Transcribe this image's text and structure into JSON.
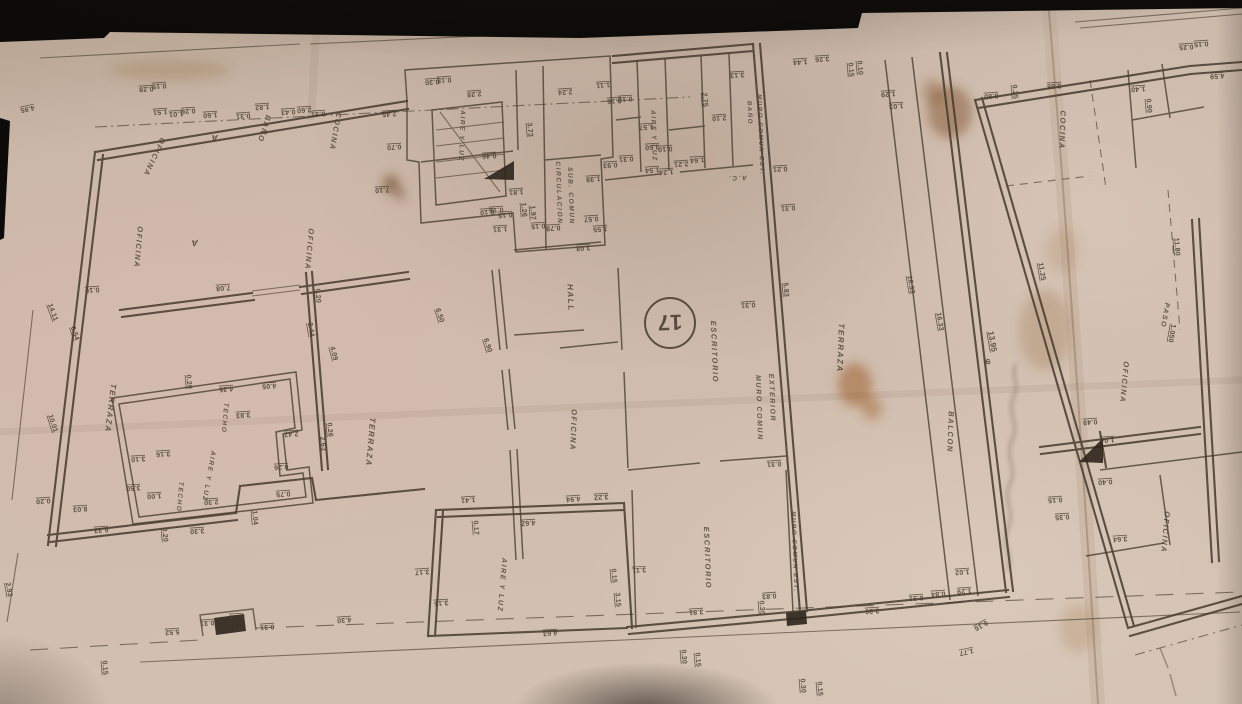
{
  "palette": {
    "paper": "#ccbaab",
    "ink": "#45392c",
    "stain": "#8a5320",
    "shadow": "#141210"
  },
  "plate": {
    "number": "17"
  },
  "handwriting": {
    "legible_part": "13.95"
  },
  "rooms": [
    {
      "t": "OFICINA",
      "x": 152,
      "y": 156,
      "r": 115,
      "s": 7.5
    },
    {
      "t": "A",
      "x": 214,
      "y": 135,
      "r": 178,
      "s": 9
    },
    {
      "t": "BAÑO",
      "x": 262,
      "y": 128,
      "r": 108,
      "s": 7.5
    },
    {
      "t": "COCINA",
      "x": 333,
      "y": 131,
      "r": 100,
      "s": 7.5
    },
    {
      "t": "OFICINA",
      "x": 136,
      "y": 247,
      "r": 95,
      "s": 7.5
    },
    {
      "t": "A",
      "x": 194,
      "y": 240,
      "r": 178,
      "s": 9
    },
    {
      "t": "OFICINA",
      "x": 307,
      "y": 249,
      "r": 95,
      "s": 7.5
    },
    {
      "t": "AIRE Y LUZ",
      "x": 460,
      "y": 136,
      "r": 92,
      "s": 6.5
    },
    {
      "t": "CIRCULACION",
      "x": 557,
      "y": 193,
      "r": 88,
      "s": 6.5
    },
    {
      "t": "SUB. COMUN",
      "x": 569,
      "y": 196,
      "r": 88,
      "s": 6.5
    },
    {
      "t": "AIRE Y LUZ",
      "x": 652,
      "y": 136,
      "r": 88,
      "s": 6.5
    },
    {
      "t": "BAÑO",
      "x": 748,
      "y": 113,
      "r": 88,
      "s": 6
    },
    {
      "t": "A.C.",
      "x": 737,
      "y": 176,
      "r": 178,
      "s": 6.5
    },
    {
      "t": "MURO COMUN EST.",
      "x": 759,
      "y": 135,
      "r": 88,
      "s": 6
    },
    {
      "t": "HALL",
      "x": 568,
      "y": 298,
      "r": 88,
      "s": 8
    },
    {
      "t": "ESCRITORIO",
      "x": 712,
      "y": 352,
      "r": 88,
      "s": 7.5
    },
    {
      "t": "MURO COMUN",
      "x": 757,
      "y": 408,
      "r": 88,
      "s": 7
    },
    {
      "t": "EXTERIOR",
      "x": 770,
      "y": 398,
      "r": 88,
      "s": 7
    },
    {
      "t": "TERRAZA",
      "x": 108,
      "y": 408,
      "r": 97,
      "s": 8
    },
    {
      "t": "TECHO",
      "x": 223,
      "y": 418,
      "r": 95,
      "s": 6.5
    },
    {
      "t": "AIRE Y LUZ",
      "x": 207,
      "y": 476,
      "r": 100,
      "s": 6.5
    },
    {
      "t": "TECHO",
      "x": 178,
      "y": 497,
      "r": 95,
      "s": 6.5
    },
    {
      "t": "TERRAZA",
      "x": 368,
      "y": 442,
      "r": 95,
      "s": 8
    },
    {
      "t": "TERRAZA",
      "x": 838,
      "y": 348,
      "r": 92,
      "s": 8
    },
    {
      "t": "BALCON",
      "x": 948,
      "y": 432,
      "r": 92,
      "s": 7.5
    },
    {
      "t": "OFICINA",
      "x": 571,
      "y": 430,
      "r": 92,
      "s": 7.5
    },
    {
      "t": "ESCRITORIO",
      "x": 705,
      "y": 558,
      "r": 88,
      "s": 7.5
    },
    {
      "t": "MURO COMUN EST.",
      "x": 793,
      "y": 552,
      "r": 88,
      "s": 6
    },
    {
      "t": "AIRE Y LUZ",
      "x": 500,
      "y": 585,
      "r": 95,
      "s": 7
    },
    {
      "t": "COCINA",
      "x": 1060,
      "y": 130,
      "r": 92,
      "s": 7.5
    },
    {
      "t": "OFICINA",
      "x": 1122,
      "y": 382,
      "r": 95,
      "s": 7.5
    },
    {
      "t": "PASO",
      "x": 1163,
      "y": 315,
      "r": 100,
      "s": 7
    },
    {
      "t": "OFICINA",
      "x": 1163,
      "y": 532,
      "r": 95,
      "s": 7.5
    }
  ],
  "dims": [
    {
      "t": "18.63",
      "x": 348,
      "y": 22,
      "r": 174,
      "s": 8
    },
    {
      "t": "4.95",
      "x": 27,
      "y": 107,
      "r": 168
    },
    {
      "t": "0.28",
      "x": 146,
      "y": 87
    },
    {
      "t": "0.15",
      "x": 159,
      "y": 84
    },
    {
      "t": "1.51",
      "x": 160,
      "y": 110
    },
    {
      "t": "1.01",
      "x": 176,
      "y": 112
    },
    {
      "t": "0.26",
      "x": 188,
      "y": 109
    },
    {
      "t": "1.60",
      "x": 210,
      "y": 113
    },
    {
      "t": "0.31",
      "x": 243,
      "y": 114
    },
    {
      "t": "1.82",
      "x": 262,
      "y": 105
    },
    {
      "t": "0.43",
      "x": 288,
      "y": 110
    },
    {
      "t": "2.60",
      "x": 304,
      "y": 108
    },
    {
      "t": "0.31",
      "x": 318,
      "y": 112
    },
    {
      "t": "2.45",
      "x": 389,
      "y": 112
    },
    {
      "t": "0.70",
      "x": 394,
      "y": 145
    },
    {
      "t": "7.10",
      "x": 382,
      "y": 188
    },
    {
      "t": "0.30",
      "x": 432,
      "y": 80
    },
    {
      "t": "0.18",
      "x": 444,
      "y": 78
    },
    {
      "t": "2.28",
      "x": 474,
      "y": 92
    },
    {
      "t": "3.73",
      "x": 528,
      "y": 130,
      "r": 85
    },
    {
      "t": "2.24",
      "x": 565,
      "y": 90
    },
    {
      "t": "1.11",
      "x": 603,
      "y": 83
    },
    {
      "t": "0.16",
      "x": 614,
      "y": 99
    },
    {
      "t": "0.10",
      "x": 625,
      "y": 97
    },
    {
      "t": "0.93",
      "x": 610,
      "y": 163
    },
    {
      "t": "0.31",
      "x": 626,
      "y": 157
    },
    {
      "t": "1.38",
      "x": 593,
      "y": 177
    },
    {
      "t": "0.46",
      "x": 489,
      "y": 154
    },
    {
      "t": "1.81",
      "x": 516,
      "y": 190
    },
    {
      "t": "0.10",
      "x": 487,
      "y": 210
    },
    {
      "t": "0.16",
      "x": 496,
      "y": 208
    },
    {
      "t": "0.15",
      "x": 505,
      "y": 213
    },
    {
      "t": "1.31",
      "x": 500,
      "y": 227
    },
    {
      "t": "1.26",
      "x": 522,
      "y": 210,
      "r": 85
    },
    {
      "t": "1.97",
      "x": 531,
      "y": 213,
      "r": 85
    },
    {
      "t": "0.15",
      "x": 538,
      "y": 224
    },
    {
      "t": "0.78",
      "x": 553,
      "y": 226
    },
    {
      "t": "3.08",
      "x": 583,
      "y": 246
    },
    {
      "t": "0.57",
      "x": 591,
      "y": 217
    },
    {
      "t": "1.55",
      "x": 600,
      "y": 227
    },
    {
      "t": "1.57",
      "x": 646,
      "y": 125
    },
    {
      "t": "3.50",
      "x": 652,
      "y": 145
    },
    {
      "t": "0.10",
      "x": 665,
      "y": 147
    },
    {
      "t": "1.64",
      "x": 697,
      "y": 158
    },
    {
      "t": "2.21",
      "x": 681,
      "y": 162
    },
    {
      "t": "1.54",
      "x": 652,
      "y": 168
    },
    {
      "t": "1.24",
      "x": 666,
      "y": 170
    },
    {
      "t": "3.13",
      "x": 737,
      "y": 73
    },
    {
      "t": "2.75",
      "x": 703,
      "y": 100,
      "r": 85
    },
    {
      "t": "2.10",
      "x": 719,
      "y": 116
    },
    {
      "t": "1.44",
      "x": 800,
      "y": 60
    },
    {
      "t": "3.26",
      "x": 822,
      "y": 57
    },
    {
      "t": "0.15",
      "x": 849,
      "y": 70,
      "r": 85
    },
    {
      "t": "0.10",
      "x": 858,
      "y": 68,
      "r": 85
    },
    {
      "t": "1.29",
      "x": 888,
      "y": 92
    },
    {
      "t": "1.03",
      "x": 896,
      "y": 104
    },
    {
      "t": "0.21",
      "x": 780,
      "y": 167
    },
    {
      "t": "0.31",
      "x": 788,
      "y": 206
    },
    {
      "t": "5.83",
      "x": 784,
      "y": 290,
      "r": 85
    },
    {
      "t": "0.31",
      "x": 748,
      "y": 303
    },
    {
      "t": "0.31",
      "x": 774,
      "y": 462
    },
    {
      "t": "16.33",
      "x": 909,
      "y": 285,
      "r": 80
    },
    {
      "t": "16.33",
      "x": 938,
      "y": 322,
      "r": 80
    },
    {
      "t": "13.95",
      "x": 990,
      "y": 342,
      "r": 80,
      "s": 8
    },
    {
      "t": "φ",
      "x": 986,
      "y": 362,
      "r": 80,
      "s": 8
    },
    {
      "t": "11.25",
      "x": 1040,
      "y": 272,
      "r": 80
    },
    {
      "t": "11.80",
      "x": 1175,
      "y": 247,
      "r": 85
    },
    {
      "t": "1.050",
      "x": 1170,
      "y": 333,
      "r": 100
    },
    {
      "t": "0.49",
      "x": 1090,
      "y": 420
    },
    {
      "t": "1.04",
      "x": 1107,
      "y": 438
    },
    {
      "t": "4.59",
      "x": 1217,
      "y": 74
    },
    {
      "t": "3.88",
      "x": 1054,
      "y": 84
    },
    {
      "t": "0.80",
      "x": 991,
      "y": 94
    },
    {
      "t": "0.25",
      "x": 1013,
      "y": 92,
      "r": 85
    },
    {
      "t": "1.40",
      "x": 1138,
      "y": 87
    },
    {
      "t": "0.90",
      "x": 1147,
      "y": 106,
      "r": 85
    },
    {
      "t": "0.25",
      "x": 1186,
      "y": 45
    },
    {
      "t": "0.15",
      "x": 1201,
      "y": 42
    },
    {
      "t": "0.15",
      "x": 602,
      "y": 21
    },
    {
      "t": "0.15",
      "x": 643,
      "y": 30
    },
    {
      "t": "3.26",
      "x": 676,
      "y": 25
    },
    {
      "t": "14.11",
      "x": 51,
      "y": 313,
      "r": 70
    },
    {
      "t": "6.54",
      "x": 73,
      "y": 334,
      "r": 72
    },
    {
      "t": "10.01",
      "x": 51,
      "y": 424,
      "r": 72
    },
    {
      "t": "2.93",
      "x": 7,
      "y": 590,
      "r": 80
    },
    {
      "t": "0.15",
      "x": 103,
      "y": 668,
      "r": 85
    },
    {
      "t": "0.20",
      "x": 43,
      "y": 499
    },
    {
      "t": "8.03",
      "x": 80,
      "y": 507
    },
    {
      "t": "6.33",
      "x": 101,
      "y": 528
    },
    {
      "t": "3.50",
      "x": 133,
      "y": 486
    },
    {
      "t": "3.10",
      "x": 138,
      "y": 457
    },
    {
      "t": "3.16",
      "x": 163,
      "y": 452
    },
    {
      "t": "1.00",
      "x": 154,
      "y": 494
    },
    {
      "t": "0.20",
      "x": 163,
      "y": 535,
      "r": 85
    },
    {
      "t": "3.30",
      "x": 197,
      "y": 529
    },
    {
      "t": "2.30",
      "x": 211,
      "y": 500
    },
    {
      "t": "0.75",
      "x": 283,
      "y": 492
    },
    {
      "t": "1.04",
      "x": 253,
      "y": 518,
      "r": 85
    },
    {
      "t": "0.26",
      "x": 281,
      "y": 465
    },
    {
      "t": "2.42",
      "x": 291,
      "y": 432
    },
    {
      "t": "2.63",
      "x": 321,
      "y": 444,
      "r": 85
    },
    {
      "t": "0.26",
      "x": 328,
      "y": 430,
      "r": 85
    },
    {
      "t": "3.83",
      "x": 243,
      "y": 413
    },
    {
      "t": "4.25",
      "x": 226,
      "y": 387
    },
    {
      "t": "4.05",
      "x": 269,
      "y": 384
    },
    {
      "t": "0.20",
      "x": 187,
      "y": 382,
      "r": 85
    },
    {
      "t": "7.08",
      "x": 223,
      "y": 286
    },
    {
      "t": "0.10",
      "x": 92,
      "y": 288
    },
    {
      "t": "6.50",
      "x": 438,
      "y": 316,
      "r": 72
    },
    {
      "t": "6.90",
      "x": 486,
      "y": 346,
      "r": 72
    },
    {
      "t": "3.44",
      "x": 309,
      "y": 330,
      "r": 80
    },
    {
      "t": "4.09",
      "x": 332,
      "y": 354,
      "r": 75
    },
    {
      "t": "0.20",
      "x": 316,
      "y": 296,
      "r": 85
    },
    {
      "t": "5.52",
      "x": 172,
      "y": 630
    },
    {
      "t": "0.31",
      "x": 207,
      "y": 621
    },
    {
      "t": "0.11",
      "x": 236,
      "y": 615
    },
    {
      "t": "0.31",
      "x": 267,
      "y": 625
    },
    {
      "t": "4.30",
      "x": 344,
      "y": 618
    },
    {
      "t": "3.17",
      "x": 422,
      "y": 570
    },
    {
      "t": "3.15",
      "x": 441,
      "y": 601
    },
    {
      "t": "0.17",
      "x": 474,
      "y": 528,
      "r": 85
    },
    {
      "t": "1.41",
      "x": 468,
      "y": 498
    },
    {
      "t": "4.62",
      "x": 528,
      "y": 521
    },
    {
      "t": "4.63",
      "x": 550,
      "y": 631
    },
    {
      "t": "0.15",
      "x": 612,
      "y": 576,
      "r": 85
    },
    {
      "t": "3.15",
      "x": 616,
      "y": 600,
      "r": 85
    },
    {
      "t": "3.11",
      "x": 639,
      "y": 568
    },
    {
      "t": "4.94",
      "x": 573,
      "y": 497
    },
    {
      "t": "3.22",
      "x": 601,
      "y": 495
    },
    {
      "t": "3.81",
      "x": 696,
      "y": 610
    },
    {
      "t": "0.30",
      "x": 682,
      "y": 657,
      "r": 85
    },
    {
      "t": "0.15",
      "x": 696,
      "y": 660,
      "r": 85
    },
    {
      "t": "0.83",
      "x": 769,
      "y": 594
    },
    {
      "t": "0.30",
      "x": 760,
      "y": 608,
      "r": 85
    },
    {
      "t": "0.30",
      "x": 801,
      "y": 686,
      "r": 85
    },
    {
      "t": "0.15",
      "x": 818,
      "y": 689,
      "r": 85
    },
    {
      "t": "3.26",
      "x": 872,
      "y": 609
    },
    {
      "t": "0.31",
      "x": 916,
      "y": 596
    },
    {
      "t": "0.84",
      "x": 938,
      "y": 592
    },
    {
      "t": "1.02",
      "x": 962,
      "y": 570
    },
    {
      "t": "1.29",
      "x": 964,
      "y": 589
    },
    {
      "t": "0.16",
      "x": 980,
      "y": 624,
      "r": 150
    },
    {
      "t": "1.77",
      "x": 966,
      "y": 650,
      "r": 168
    },
    {
      "t": "0.15",
      "x": 1055,
      "y": 498
    },
    {
      "t": "0.35",
      "x": 1062,
      "y": 515
    },
    {
      "t": "0.40",
      "x": 1105,
      "y": 480
    },
    {
      "t": "3.64",
      "x": 1120,
      "y": 537
    }
  ]
}
